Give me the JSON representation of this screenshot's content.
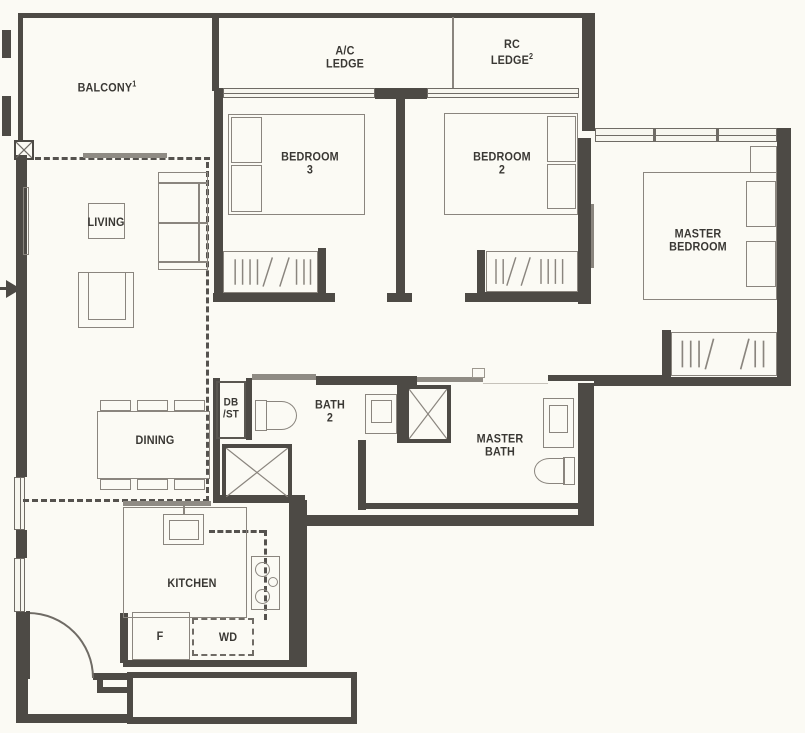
{
  "plan": {
    "title": "3-bedroom apartment floor plan",
    "colors": {
      "background": "#fbfaf4",
      "wall": "#4d4a45",
      "furniture_line": "#8a857e",
      "text": "#3a3834"
    },
    "rooms": {
      "balcony": {
        "label": "BALCONY",
        "sup": "1"
      },
      "ac_ledge": {
        "line1": "A/C",
        "line2": "LEDGE"
      },
      "rc_ledge": {
        "line1": "RC",
        "line2": "LEDGE",
        "sup": "2"
      },
      "bedroom3": {
        "line1": "BEDROOM",
        "line2": "3"
      },
      "bedroom2": {
        "line1": "BEDROOM",
        "line2": "2"
      },
      "master_bedroom": {
        "line1": "MASTER",
        "line2": "BEDROOM"
      },
      "living": {
        "label": "LIVING"
      },
      "dining": {
        "label": "DINING"
      },
      "db_st": {
        "line1": "DB",
        "line2": "/ST"
      },
      "bath2": {
        "line1": "BATH",
        "line2": "2"
      },
      "master_bath": {
        "line1": "MASTER",
        "line2": "BATH"
      },
      "kitchen": {
        "label": "KITCHEN"
      }
    },
    "appliances": {
      "fridge": {
        "label": "F"
      },
      "washer_dryer": {
        "label": "WD"
      }
    }
  }
}
